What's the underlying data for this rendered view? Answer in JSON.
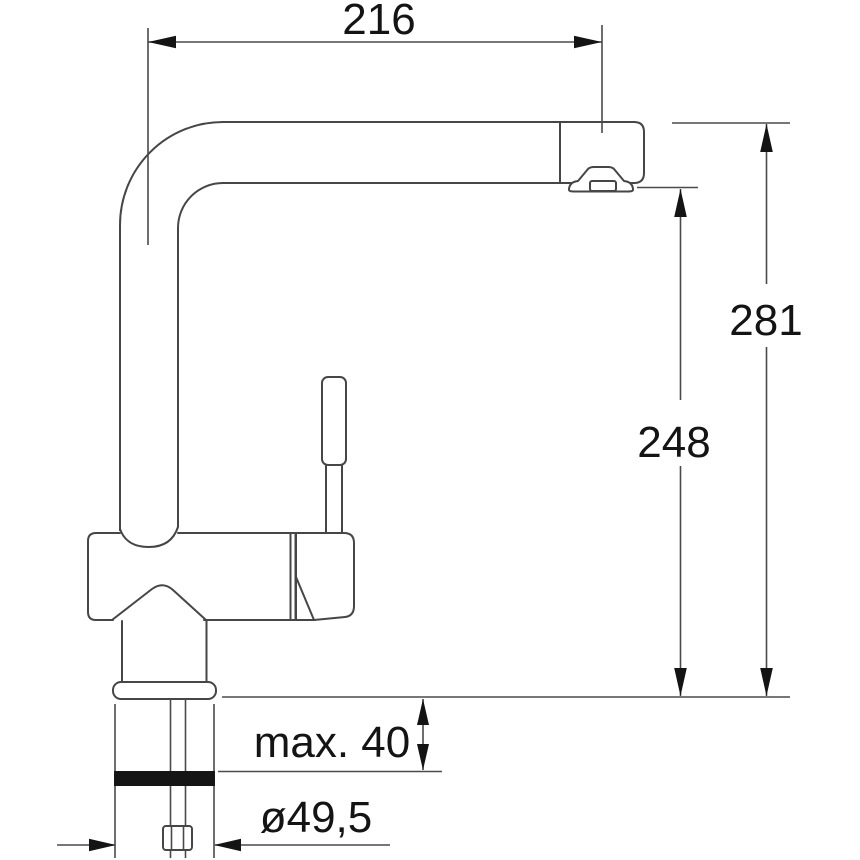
{
  "drawing": {
    "type": "technical-dimension-drawing",
    "subject": "single-lever kitchen mixer tap with L-shaped swivel spout, side elevation",
    "unit": "mm",
    "labels": {
      "spout_reach": "216",
      "total_height": "281",
      "outlet_height": "248",
      "deck_thickness": "max. 40",
      "hole_diameter": "ø49,5"
    },
    "colors": {
      "background": "#ffffff",
      "outline": "#464646",
      "dimension_lines": "#4a4a4a",
      "text_and_arrows": "#141414",
      "seal_band": "#151515"
    }
  }
}
